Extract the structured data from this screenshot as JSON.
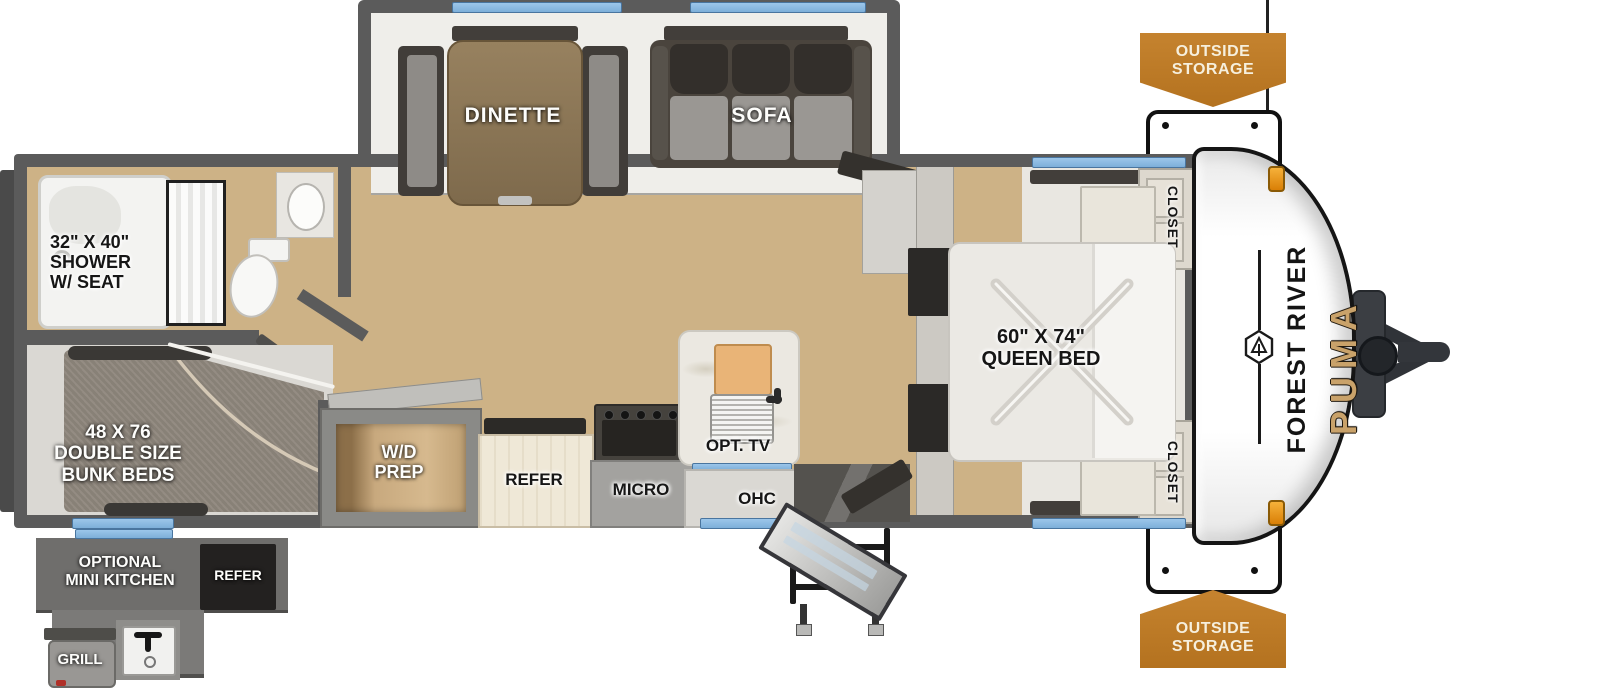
{
  "diagram": {
    "type": "travel-trailer-floorplan",
    "brand": "FOREST RIVER",
    "model": "PUMA"
  },
  "labels": {
    "storage_top": "OUTSIDE\nSTORAGE",
    "storage_bottom": "OUTSIDE\nSTORAGE",
    "dinette": "DINETTE",
    "sofa": "SOFA",
    "shower": "32\" X 40\"\nSHOWER\nW/ SEAT",
    "bunks": "48 X 76\nDOUBLE SIZE\nBUNK BEDS",
    "wd_prep": "W/D\nPREP",
    "refer": "REFER",
    "micro": "MICRO",
    "ohc": "OHC",
    "opt_tv": "OPT. TV",
    "queen_bed": "60\" X 74\"\nQUEEN BED",
    "closet_top": "CLOSET",
    "closet_bottom": "CLOSET",
    "mini_kitchen": "OPTIONAL\nMINI KITCHEN",
    "mini_refer": "REFER",
    "grill": "GRILL"
  },
  "colors": {
    "wall_gray": "#5b5b5b",
    "floor_wood": "#cdb286",
    "window_blue": "#8cbbe4",
    "banner_orange": "#bf7d2e",
    "puma_gold": "#c9a26a",
    "marker_light_orange": "#e8930f"
  }
}
